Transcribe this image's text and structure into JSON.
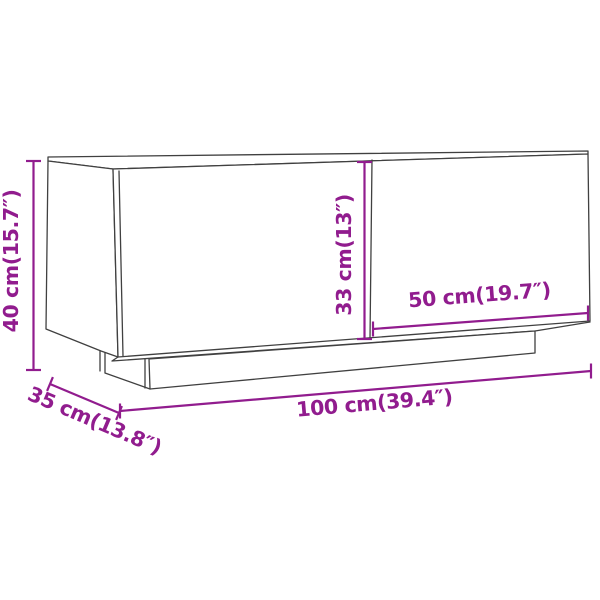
{
  "figure": {
    "type": "product-dimension-diagram",
    "subject": "tv-cabinet-line-drawing",
    "colors": {
      "dimension": "#911c8e",
      "outline": "#404040",
      "background": "#ffffff"
    },
    "dimensions": [
      {
        "id": "height",
        "label": "40 cm(15.7″)",
        "value_cm": 40,
        "value_inch": 15.7
      },
      {
        "id": "door-height",
        "label": "33 cm(13″)",
        "value_cm": 33,
        "value_inch": 13
      },
      {
        "id": "door-width",
        "label": "50 cm(19.7″)",
        "value_cm": 50,
        "value_inch": 19.7
      },
      {
        "id": "width",
        "label": "100 cm(39.4″)",
        "value_cm": 100,
        "value_inch": 39.4
      },
      {
        "id": "depth",
        "label": "35 cm(13.8″)",
        "value_cm": 35,
        "value_inch": 13.8
      }
    ]
  }
}
